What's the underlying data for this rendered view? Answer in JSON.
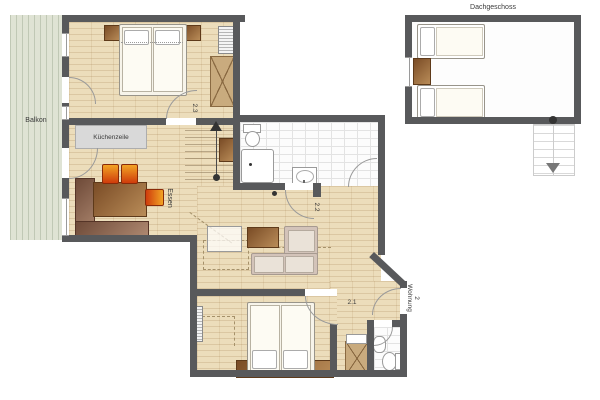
{
  "floorplan": {
    "labels": {
      "balcony": "Balkon",
      "kitchenette": "Küchenzeile",
      "dining": "Essen",
      "attic": "Dachgeschoss",
      "room_bedroom_top": "2.3",
      "room_living": "2.2",
      "room_hall": "2.1",
      "entrance_name": "Wohnung",
      "entrance_number": "2"
    },
    "colors": {
      "wall": "#58595b",
      "wood_floor": "#ecddbb",
      "balcony_floor": "#dfe3d4",
      "tile_floor": "#fcfcfc",
      "attic_floor": "#fdfdfd",
      "chair_accent": "#e07818",
      "furniture_brown": "#9b6a3e",
      "sofa": "#d3c3b9",
      "counter": "#d9d9d9"
    },
    "symbols": {
      "stairs_up": "stairs-up-arrow",
      "stairs_down": "stairs-down-arrow",
      "stair_dot": "stair-start-dot"
    }
  }
}
